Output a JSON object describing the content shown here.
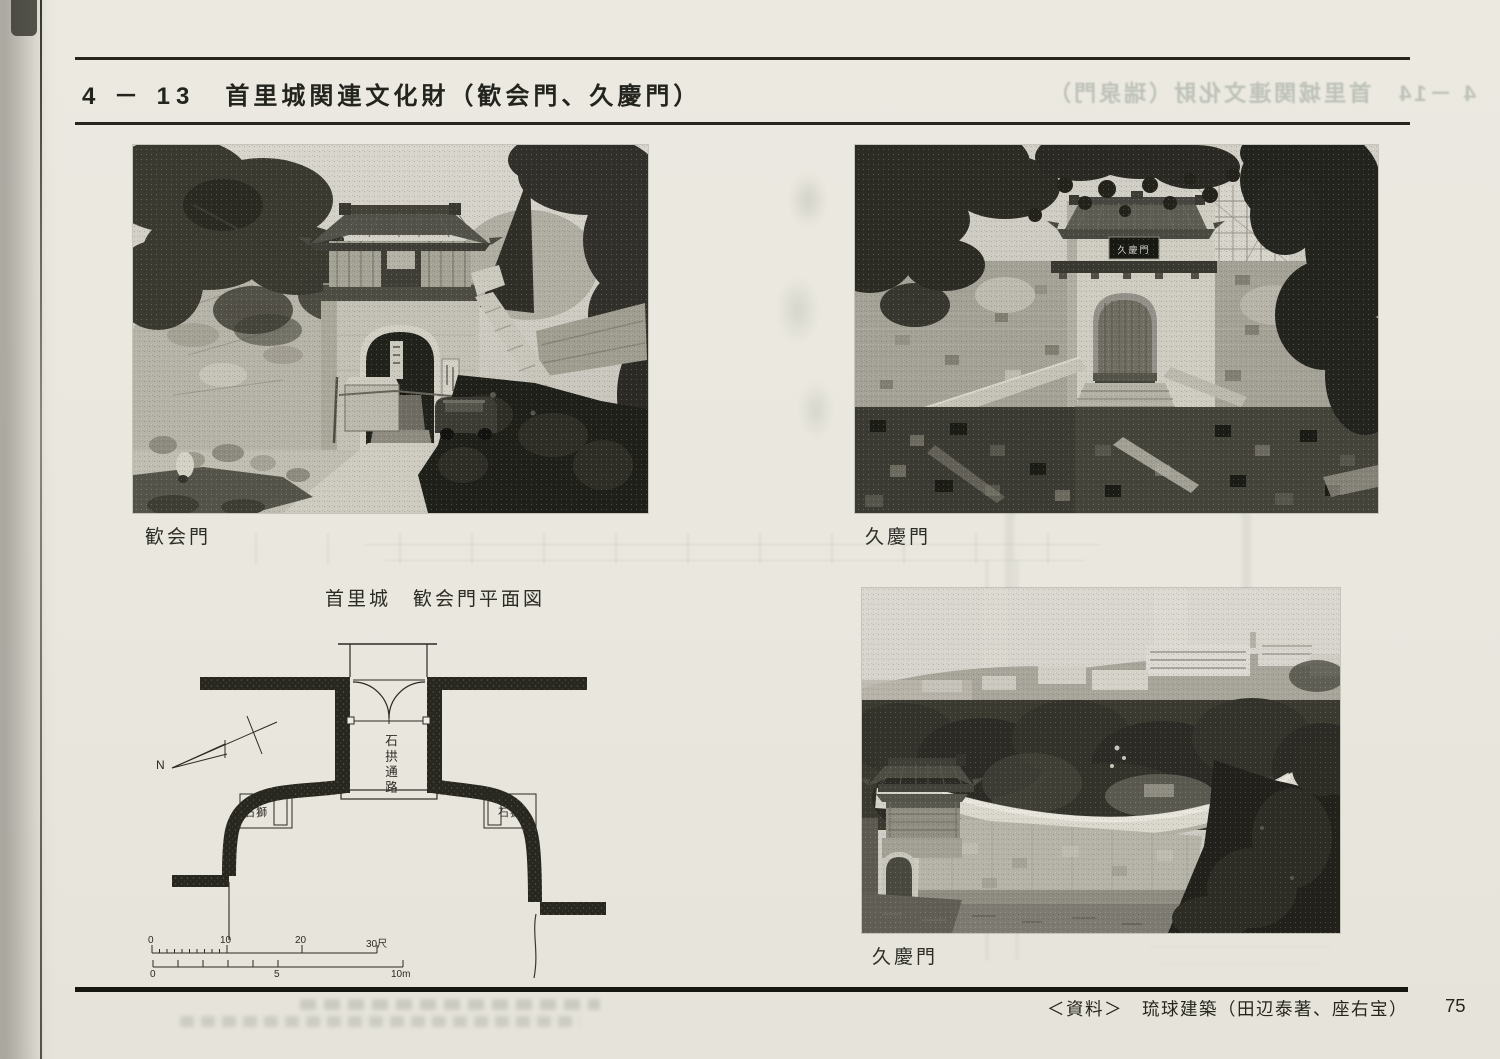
{
  "header": {
    "section": "4 － 13",
    "title": "首里城関連文化財（歓会門、久慶門）",
    "bleed_title": "4 －14　首里城関連文化財（瑞泉門）"
  },
  "photos": {
    "kankaimon": {
      "caption": "歓会門"
    },
    "kyukeimon_front": {
      "caption": "久慶門",
      "plaque": "久慶門"
    },
    "kyukeimon_view": {
      "caption": "久慶門"
    }
  },
  "plan": {
    "title": "首里城　歓会門平面図",
    "north_label": "N",
    "passage_label": "石拱通路",
    "lion_left_label": "石獅",
    "lion_right_label": "石獅",
    "scale_shaku": [
      "0",
      "10",
      "20",
      "30尺"
    ],
    "scale_m": [
      "0",
      "5",
      "10m"
    ]
  },
  "footer": {
    "source": "＜資料＞　琉球建築（田辺泰著、座右宝）",
    "page_number": "75"
  },
  "colors": {
    "paper": "#e9e7de",
    "ink": "#26261f",
    "photo_shadow": "#22221c"
  }
}
